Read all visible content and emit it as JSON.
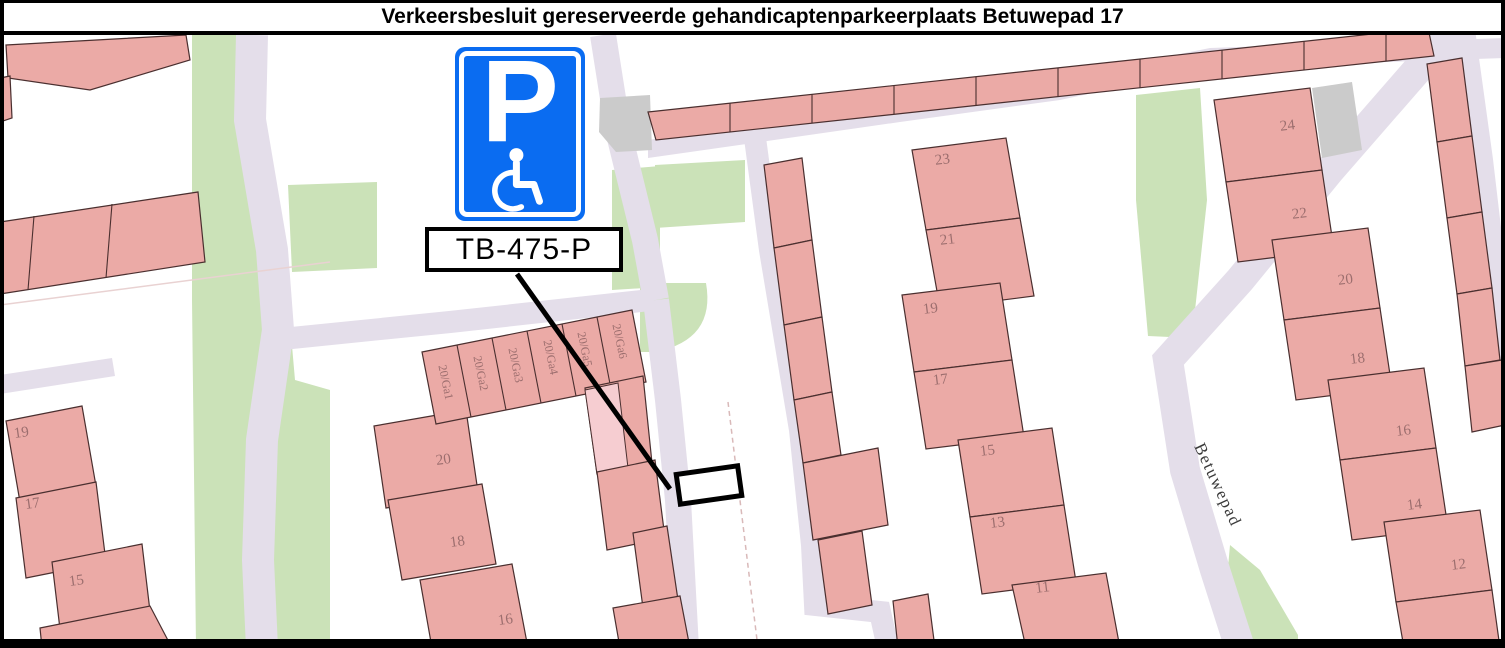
{
  "title": "Verkeersbesluit gereserveerde gehandicaptenparkeerplaats Betuwepad 17",
  "sign": {
    "letter": "P",
    "code": "TB-475-P",
    "blue": "#0a6cf1"
  },
  "map": {
    "colors": {
      "building_pink": "#ebaaa6",
      "building_highlight": "#f6cdd1",
      "road_lavender": "#e4deea",
      "green_area": "#cbe2b8",
      "gray_building": "#cbcbcb",
      "house_number_red": "#9c6e6e",
      "sign_blue": "#0a6cf1"
    },
    "street_label": {
      "t": "Betuwepad",
      "x": 1213,
      "y": 487,
      "r": 65
    },
    "house_numbers": [
      {
        "t": "19",
        "x": 22,
        "y": 437,
        "r": -8
      },
      {
        "t": "17",
        "x": 33,
        "y": 508,
        "r": -8
      },
      {
        "t": "15",
        "x": 77,
        "y": 585,
        "r": -8
      },
      {
        "t": "20",
        "x": 444,
        "y": 464,
        "r": -8
      },
      {
        "t": "18",
        "x": 458,
        "y": 546,
        "r": -8
      },
      {
        "t": "16",
        "x": 506,
        "y": 624,
        "r": -8
      },
      {
        "t": "23",
        "x": 943,
        "y": 164,
        "r": -7
      },
      {
        "t": "21",
        "x": 948,
        "y": 244,
        "r": -7
      },
      {
        "t": "19",
        "x": 931,
        "y": 313,
        "r": -7
      },
      {
        "t": "17",
        "x": 941,
        "y": 384,
        "r": -7
      },
      {
        "t": "15",
        "x": 988,
        "y": 455,
        "r": -7
      },
      {
        "t": "13",
        "x": 998,
        "y": 527,
        "r": -7
      },
      {
        "t": "11",
        "x": 1043,
        "y": 592,
        "r": -7
      },
      {
        "t": "24",
        "x": 1288,
        "y": 130,
        "r": -7
      },
      {
        "t": "22",
        "x": 1300,
        "y": 218,
        "r": -7
      },
      {
        "t": "20",
        "x": 1346,
        "y": 284,
        "r": -7
      },
      {
        "t": "18",
        "x": 1358,
        "y": 363,
        "r": -7
      },
      {
        "t": "16",
        "x": 1404,
        "y": 435,
        "r": -7
      },
      {
        "t": "14",
        "x": 1415,
        "y": 509,
        "r": -7
      },
      {
        "t": "12",
        "x": 1459,
        "y": 569,
        "r": -7
      }
    ],
    "garage_numbers": [
      {
        "t": "20/Ga1",
        "x": 442,
        "y": 383,
        "r": 78
      },
      {
        "t": "20/Ga2",
        "x": 477,
        "y": 374,
        "r": 78
      },
      {
        "t": "20/Ga3",
        "x": 512,
        "y": 366,
        "r": 78
      },
      {
        "t": "20/Ga4",
        "x": 547,
        "y": 358,
        "r": 78
      },
      {
        "t": "20/Ga5",
        "x": 581,
        "y": 350,
        "r": 78
      },
      {
        "t": "20/Ga6",
        "x": 616,
        "y": 342,
        "r": 78
      }
    ]
  }
}
